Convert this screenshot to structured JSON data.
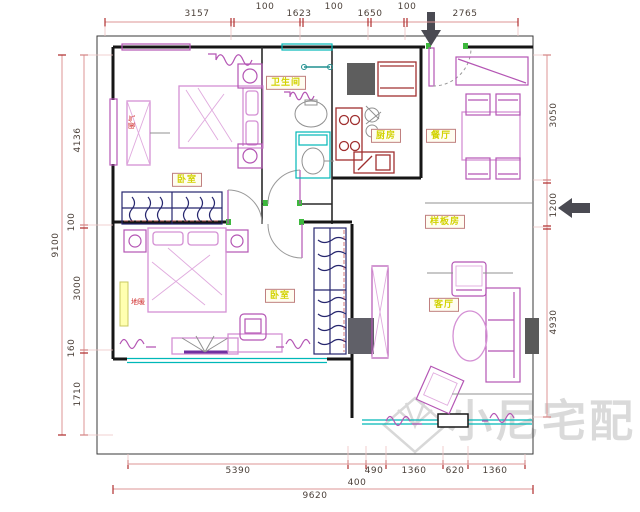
{
  "rooms": {
    "bedroom1": "卧室",
    "bathroom": "卫生间",
    "kitchen": "厨房",
    "dining": "餐厅",
    "model_room": "样板房",
    "bedroom2": "卧室",
    "living": "客厅"
  },
  "small_labels": {
    "radiator_vertical": "暖气",
    "floor_heating": "地暖"
  },
  "dimensions": {
    "top": [
      "3157",
      "100",
      "1623",
      "100",
      "1650",
      "100",
      "2765"
    ],
    "left_total": "9100",
    "left": [
      "4136",
      "100",
      "3000",
      "160",
      "1710"
    ],
    "right": [
      "3050",
      "1200",
      "4930"
    ],
    "bottom": [
      "5390",
      "400",
      "490",
      "1360",
      "620",
      "1360"
    ],
    "bottom_total": "9620"
  },
  "watermark": {
    "text": "小尼宅配"
  },
  "colors": {
    "wall": "#161616",
    "dimension_line": "#dd9494",
    "dimension_text": "#4a3f38",
    "furniture_pink": "#d490d4",
    "furniture_magenta": "#b455b4",
    "cabinet_navy": "#26266e",
    "fixture_cyan": "#00b8b8",
    "appliance_red": "#a03030",
    "door_jamb_green": "#3db83d",
    "room_label_yellow": "#d2d200",
    "watermark_gray": "#dadada"
  }
}
